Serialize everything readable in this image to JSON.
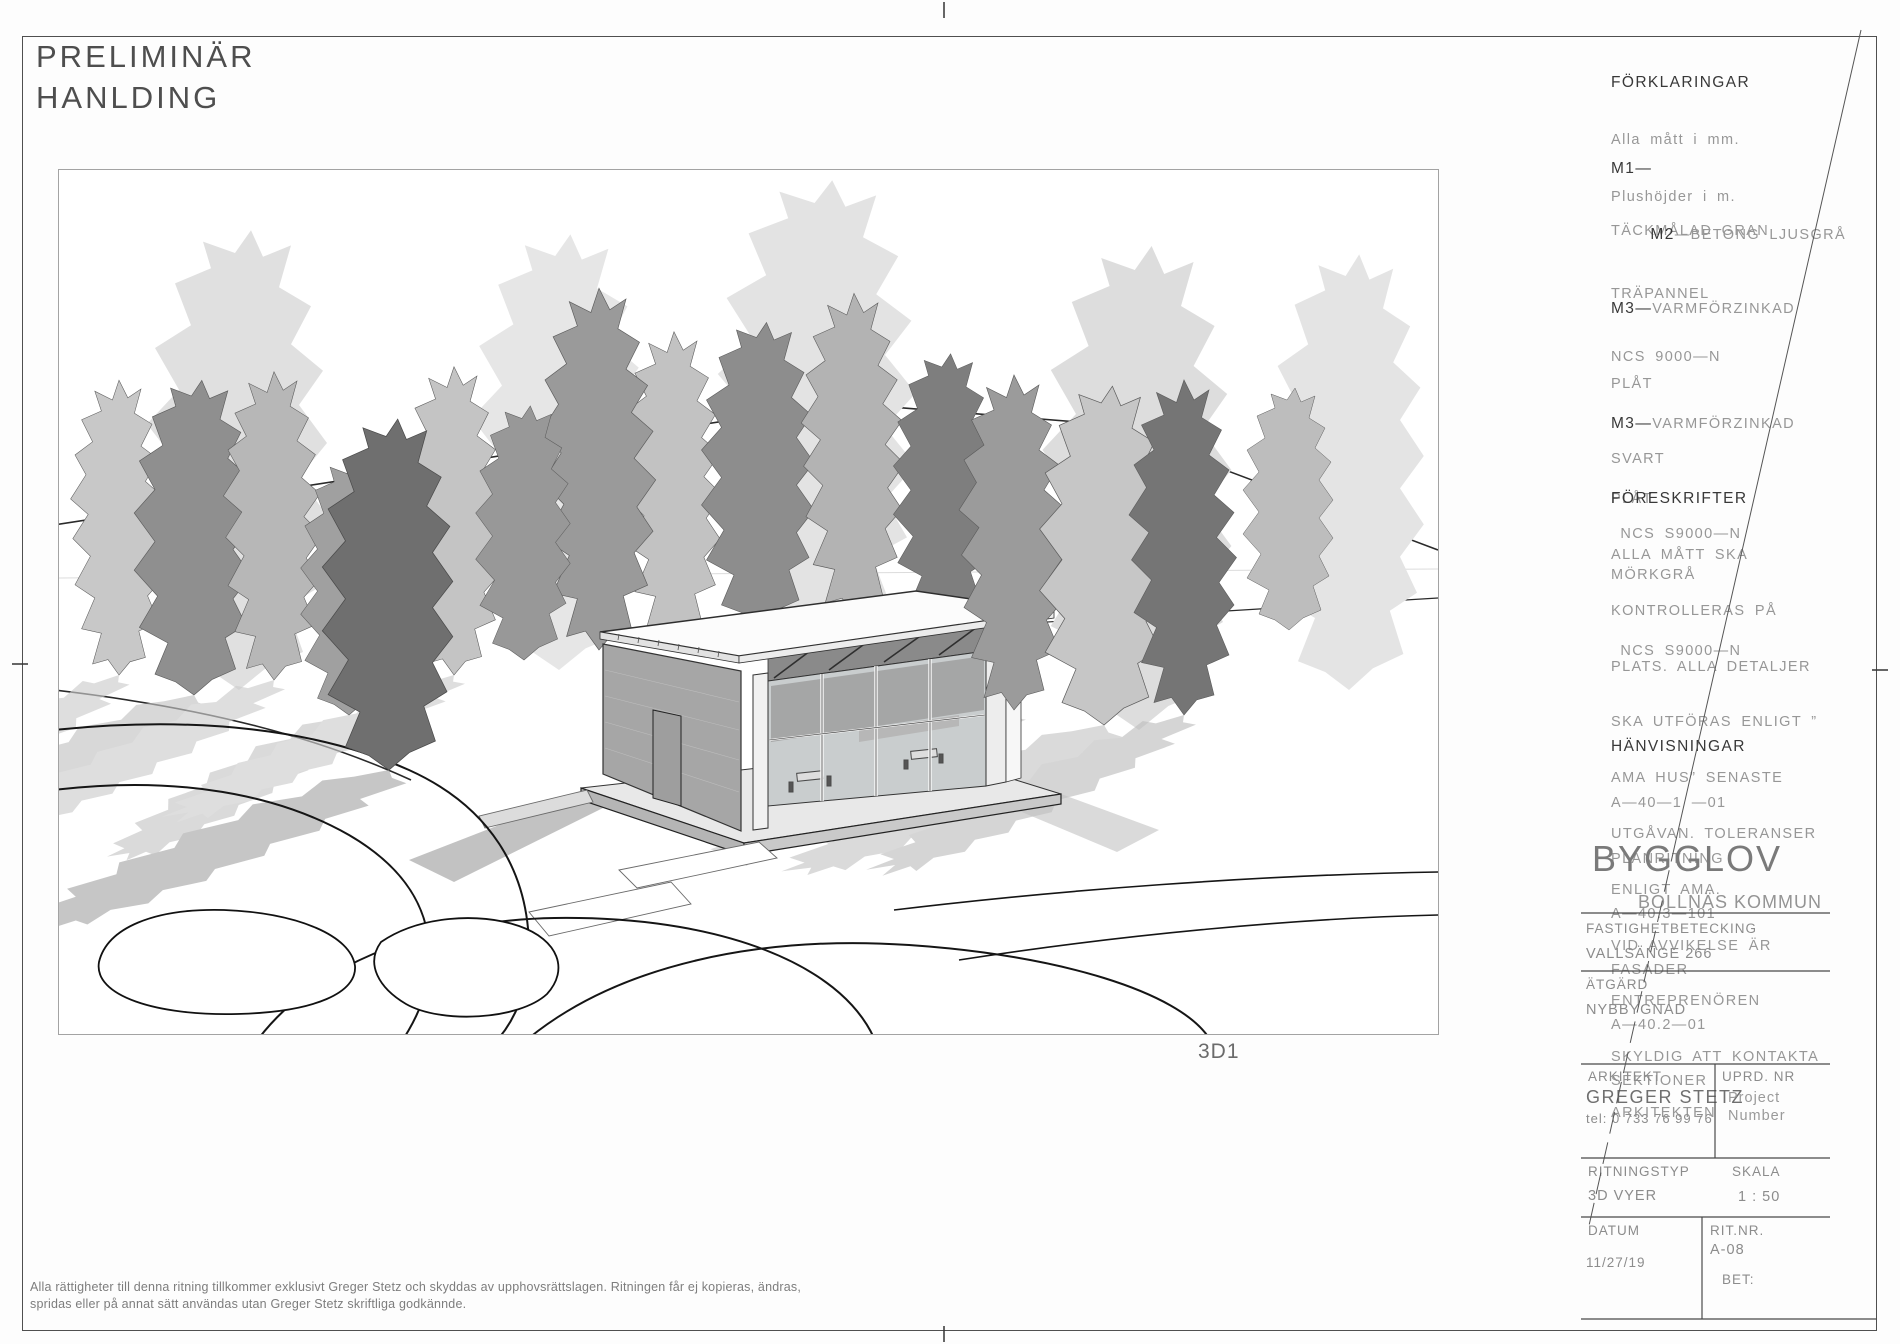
{
  "colors": {
    "sheet_border": "#4f4f4f",
    "viewport_border": "#a3a3a3",
    "cad_header_text": "#383838",
    "cad_body_text": "#979797",
    "stamp_text": "#4e4e4e",
    "line_work": "#222222",
    "tree_light": "#c6c6c6",
    "tree_mid": "#9a9a9a",
    "tree_dark": "#6f6f6f"
  },
  "stamp": {
    "line1": "PRELIMINÄR",
    "line2": "HANLDING"
  },
  "viewport": {
    "label": "3D1"
  },
  "legend": {
    "forklaringar": {
      "title": "FÖRKLARINGAR",
      "lines": [
        "Alla mått i mm.",
        "Plushöjder i m."
      ]
    },
    "m1": {
      "code": "M1—",
      "lines": [
        "TÄCKMÅLAD GRAN",
        "TRÄPANNEL",
        "NCS 9000—N"
      ]
    },
    "m2": {
      "code": "M2",
      "rest": "—BETONG LJUSGRÅ"
    },
    "m3a": {
      "code": "M3—",
      "head": "VARMFÖRZINKAD",
      "lines": [
        "PLÅT",
        "SVART",
        " NCS S9000—N"
      ]
    },
    "m3b": {
      "code": "M3—",
      "head": "VARMFÖRZINKAD",
      "lines": [
        "PLÅT",
        "MÖRKGRÅ",
        " NCS S9000—N"
      ]
    },
    "foreskrifter": {
      "title": "FÖRESKRIFTER",
      "lines": [
        "ALLA MÅTT SKA",
        "KONTROLLERAS PÅ",
        "PLATS. ALLA DETALJER",
        "SKA UTFÖRAS ENLIGT ”",
        "AMA HUS” SENASTE",
        "UTGÅVAN. TOLERANSER",
        "ENLIGT AMA.",
        "VID AVVIKELSE ÄR",
        "ENTREPRENÖREN",
        "SKYLDIG ATT KONTAKTA",
        "ARKITEKTEN"
      ]
    },
    "hanvisningar": {
      "title": "HÄNVISNINGAR",
      "lines": [
        "A—40—1 —01",
        "PLANRITNING",
        "A—40.3—101",
        "FASADER",
        "A—40.2—01",
        "SEKTIONER"
      ]
    }
  },
  "titleblock": {
    "stamp_title": "BYGGLOV",
    "municipality": "BOLLNÄS KOMMUN",
    "property_label": "FASTIGHETBETECKING",
    "property_value": "VALLSÄNGE 266",
    "action_label": "ÄTGÄRD",
    "action_value": "NYBBYGNAD",
    "architect_label": "ARKITEKT",
    "architect_name": "GREGER STETZ",
    "architect_tel": "tel: 0 733 76 99 76",
    "uprd_label": "UPRD. NR",
    "uprd_line1": "Project",
    "uprd_line2": "Number",
    "drawing_type_label": "RITNINGSTYP",
    "drawing_type_value": "3D VYER",
    "scale_label": "SKALA",
    "scale_value": "1 : 50",
    "date_label": "DATUM",
    "date_value": "11/27/19",
    "drawing_no_label": "RIT.NR.",
    "drawing_no_value": "A-08",
    "revision_label": "BET:"
  },
  "footer": {
    "line1": "Alla rättigheter till denna ritning tillkommer exklusivt Greger Stetz och skyddas av upphovsrättslagen. Ritningen får ej kopieras, ändras,",
    "line2": "spridas eller på annat sätt användas utan Greger Stetz skriftliga godkännde."
  }
}
